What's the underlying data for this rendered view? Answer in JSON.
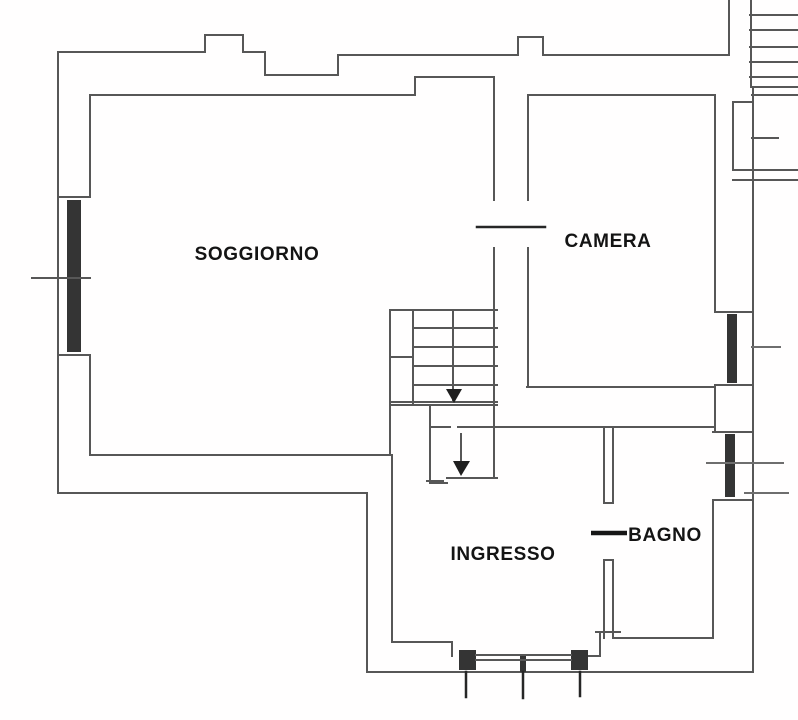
{
  "diagram": {
    "type": "floor-plan",
    "background_color": "#ffffff",
    "wall_color": "#575757",
    "accent_color": "#262626",
    "text_color": "#141414",
    "rooms": [
      {
        "name": "SOGGIORNO"
      },
      {
        "name": "CAMERA"
      },
      {
        "name": "INGRESSO"
      },
      {
        "name": "BAGNO"
      }
    ],
    "features": [
      "internal-staircase-with-down-arrows",
      "external-staircase-top-right",
      "balcony-landing-right",
      "window-left-wall",
      "window-east-wall-upper",
      "window-east-wall-lower",
      "french-window-south-wall",
      "camera-door-mark",
      "bagno-door-mark"
    ]
  }
}
